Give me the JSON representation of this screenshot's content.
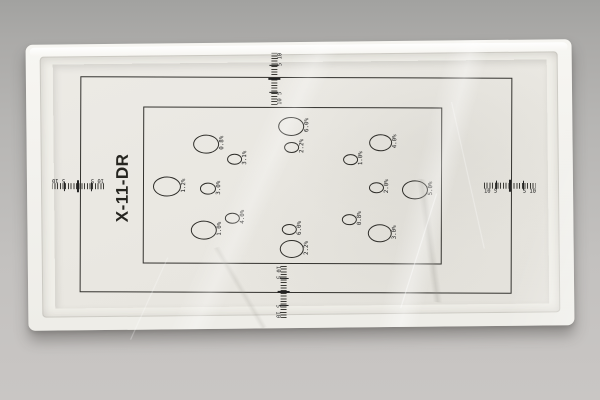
{
  "photo": {
    "subject": "X-ray DR contrast-detail test plate in clear plastic wrap on gray surface"
  },
  "plate": {
    "title": "X-11-DR",
    "scale": {
      "left": "10 5",
      "right": "5 10"
    },
    "scales": [
      {
        "side": "top"
      },
      {
        "side": "bottom"
      },
      {
        "side": "left"
      },
      {
        "side": "right"
      }
    ],
    "circles": [
      {
        "x": 290,
        "y": 125,
        "w": 24,
        "h": 17,
        "label": "6.0%"
      },
      {
        "x": 205,
        "y": 143,
        "w": 24,
        "h": 17,
        "label": "0.8%"
      },
      {
        "x": 233,
        "y": 158,
        "w": 13,
        "h": 9,
        "label": "3.1%"
      },
      {
        "x": 290,
        "y": 146,
        "w": 13,
        "h": 9,
        "label": "2.2%"
      },
      {
        "x": 349,
        "y": 158,
        "w": 13,
        "h": 9,
        "label": "1.0%"
      },
      {
        "x": 379,
        "y": 141,
        "w": 21,
        "h": 15,
        "label": "4.0%"
      },
      {
        "x": 166,
        "y": 186,
        "w": 26,
        "h": 18,
        "label": "1.2%"
      },
      {
        "x": 207,
        "y": 188,
        "w": 14,
        "h": 10,
        "label": "3.0%"
      },
      {
        "x": 375,
        "y": 186,
        "w": 13,
        "h": 9,
        "label": "2.0%"
      },
      {
        "x": 414,
        "y": 188,
        "w": 24,
        "h": 17,
        "label": "5.0%"
      },
      {
        "x": 231,
        "y": 217,
        "w": 13,
        "h": 9,
        "label": "4.0%"
      },
      {
        "x": 203,
        "y": 229,
        "w": 24,
        "h": 17,
        "label": "1.0%"
      },
      {
        "x": 288,
        "y": 228,
        "w": 13,
        "h": 9,
        "label": "6.0%"
      },
      {
        "x": 291,
        "y": 248,
        "w": 22,
        "h": 16,
        "label": "2.2%"
      },
      {
        "x": 348,
        "y": 218,
        "w": 13,
        "h": 9,
        "label": "0.8%"
      },
      {
        "x": 379,
        "y": 232,
        "w": 22,
        "h": 16,
        "label": "3.0%"
      }
    ],
    "colors": {
      "paper": "#eae8e2",
      "line": "#33322e",
      "frame": "#f4f3ef",
      "background_top": "#a2a2a0",
      "background_bottom": "#c9c6c4"
    }
  }
}
